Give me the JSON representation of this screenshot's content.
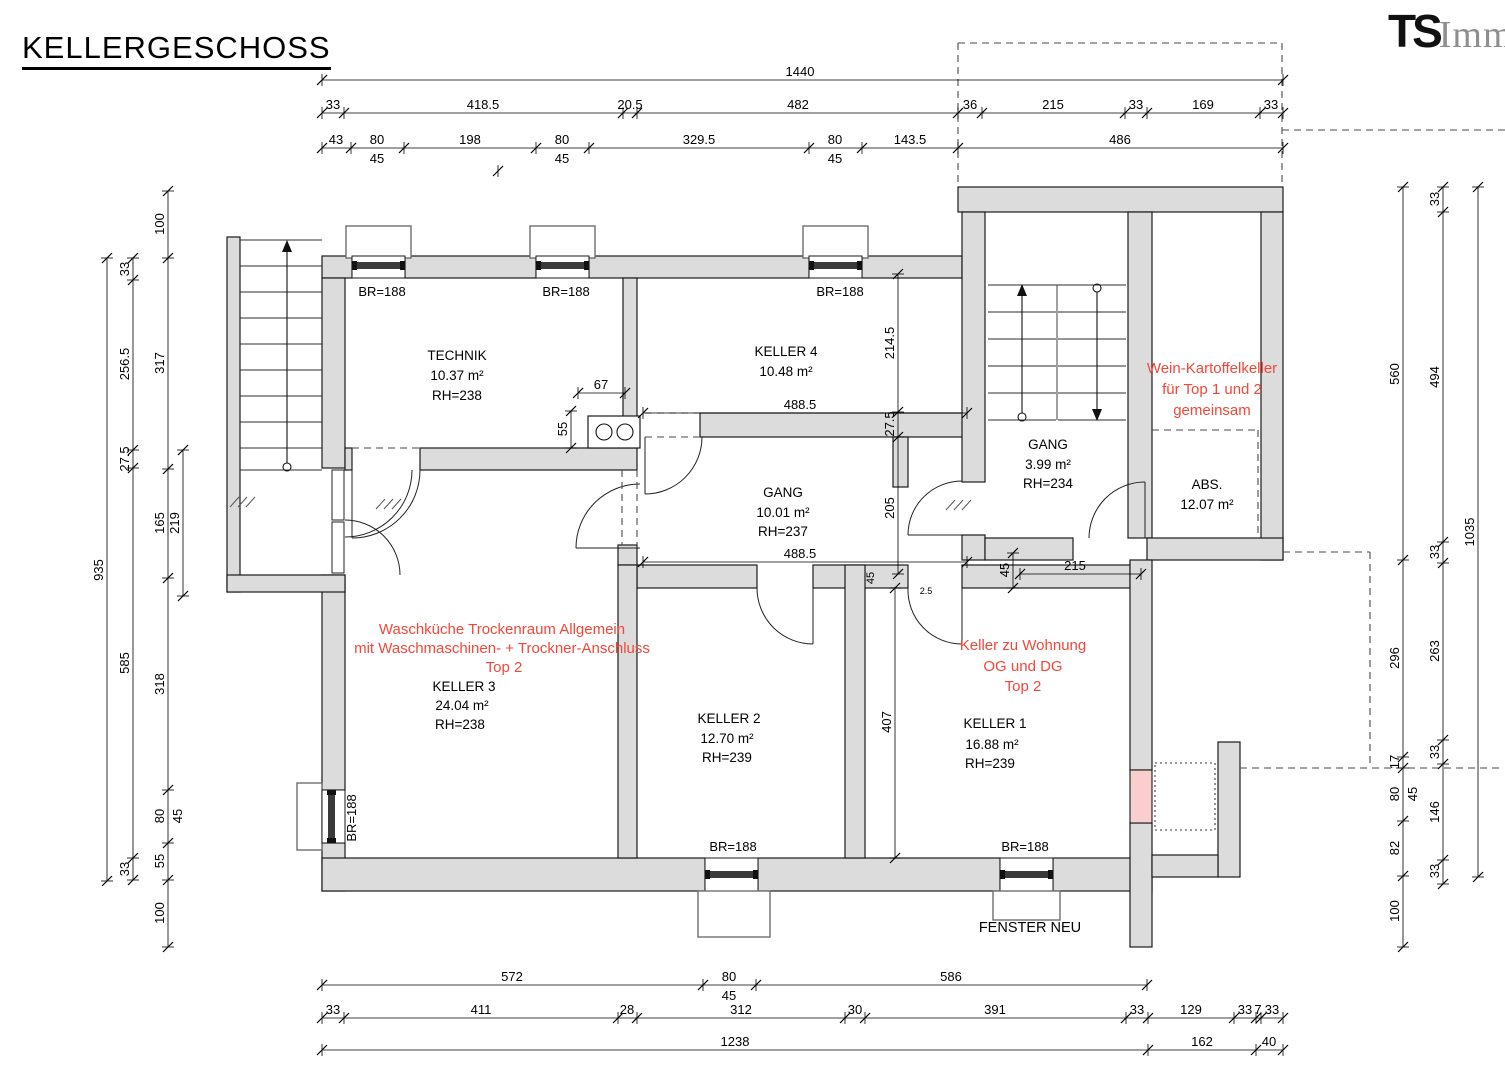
{
  "title": "KELLERGESCHOSS",
  "logo": {
    "bold": "TS",
    "rest": "Immo"
  },
  "colors": {
    "wall_fill": "#dcdcdc",
    "annotation_red": "#f4473a",
    "new_window_pink": "#f9cfcd",
    "background": "#ffffff"
  },
  "rooms": {
    "technik": {
      "name": "TECHNIK",
      "area": "10.37 m²",
      "rh": "RH=238"
    },
    "keller4": {
      "name": "KELLER 4",
      "area": "10.48 m²"
    },
    "gang": {
      "name": "GANG",
      "area": "10.01 m²",
      "rh": "RH=237"
    },
    "gang_stiegenhaus": {
      "name": "GANG",
      "area": "3.99 m²",
      "rh": "RH=234"
    },
    "abs": {
      "name": "ABS.",
      "area": "12.07 m²"
    },
    "keller3": {
      "name": "KELLER 3",
      "area": "24.04 m²",
      "rh": "RH=238"
    },
    "keller2": {
      "name": "KELLER 2",
      "area": "12.70 m²",
      "rh": "RH=239"
    },
    "keller1": {
      "name": "KELLER 1",
      "area": "16.88 m²",
      "rh": "RH=239"
    }
  },
  "annotations": {
    "keller3_red": [
      "Waschküche Trockenraum Allgemein",
      "mit Waschmaschinen- + Trockner-Anschluss",
      "Top 2"
    ],
    "keller1_red": [
      "Keller zu Wohnung",
      "OG und DG",
      "Top 2"
    ],
    "wein_red": [
      "Wein-Kartoffelkeller",
      "für Top 1 und 2",
      "gemeinsam"
    ],
    "fenster_neu": "FENSTER NEU",
    "br188": "BR=188"
  },
  "dim_chains": [
    {
      "o": "h",
      "c": 80,
      "s": 322,
      "e": 1283,
      "k": [
        322,
        1283
      ],
      "l": [
        {
          "t": "1440",
          "p": 800
        }
      ]
    },
    {
      "o": "h",
      "c": 113,
      "s": 322,
      "e": 1283,
      "k": [
        322,
        344,
        623,
        637,
        958,
        982,
        1125,
        1147,
        1260,
        1283
      ],
      "l": [
        {
          "t": "33",
          "p": 333
        },
        {
          "t": "418.5",
          "p": 483
        },
        {
          "t": "20.5",
          "p": 630
        },
        {
          "t": "482",
          "p": 798
        },
        {
          "t": "36",
          "p": 970
        },
        {
          "t": "215",
          "p": 1053
        },
        {
          "t": "33",
          "p": 1136
        },
        {
          "t": "169",
          "p": 1203
        },
        {
          "t": "33",
          "p": 1271
        }
      ]
    },
    {
      "o": "h",
      "c": 148,
      "s": 322,
      "e": 1283,
      "k": [
        322,
        351,
        404,
        536,
        589,
        809,
        862,
        958,
        1283
      ],
      "l": [
        {
          "t": "43",
          "p": 336
        },
        {
          "t": "80",
          "p": 377
        },
        {
          "t": "45",
          "p": 377,
          "f": 1
        },
        {
          "t": "198",
          "p": 470
        },
        {
          "t": "80",
          "p": 562
        },
        {
          "t": "45",
          "p": 562,
          "f": 1
        },
        {
          "t": "329.5",
          "p": 699
        },
        {
          "t": "80",
          "p": 835
        },
        {
          "t": "45",
          "p": 835,
          "f": 1
        },
        {
          "t": "143.5",
          "p": 910
        },
        {
          "t": "486",
          "p": 1120
        }
      ]
    },
    {
      "o": "h",
      "c": 985,
      "s": 322,
      "e": 1147,
      "k": [
        322,
        703,
        756,
        1147
      ],
      "l": [
        {
          "t": "572",
          "p": 512
        },
        {
          "t": "80",
          "p": 729
        },
        {
          "t": "45",
          "p": 729,
          "f": 1
        },
        {
          "t": "586",
          "p": 951
        }
      ]
    },
    {
      "o": "h",
      "c": 1018,
      "s": 322,
      "e": 1283,
      "k": [
        322,
        344,
        618,
        637,
        845,
        865,
        1126,
        1148,
        1234,
        1256,
        1261,
        1283
      ],
      "l": [
        {
          "t": "33",
          "p": 333
        },
        {
          "t": "411",
          "p": 481
        },
        {
          "t": "28",
          "p": 627
        },
        {
          "t": "312",
          "p": 741
        },
        {
          "t": "30",
          "p": 855
        },
        {
          "t": "391",
          "p": 995
        },
        {
          "t": "33",
          "p": 1137
        },
        {
          "t": "129",
          "p": 1191
        },
        {
          "t": "33",
          "p": 1245
        },
        {
          "t": "7",
          "p": 1258
        },
        {
          "t": "33",
          "p": 1272
        }
      ]
    },
    {
      "o": "h",
      "c": 1050,
      "s": 322,
      "e": 1283,
      "k": [
        322,
        1148,
        1256,
        1283
      ],
      "l": [
        {
          "t": "1238",
          "p": 735
        },
        {
          "t": "162",
          "p": 1202
        },
        {
          "t": "40",
          "p": 1269
        }
      ]
    },
    {
      "o": "v",
      "c": 107,
      "s": 258,
      "e": 881,
      "k": [
        258,
        881
      ],
      "l": [
        {
          "t": "935",
          "p": 570
        }
      ]
    },
    {
      "o": "v",
      "c": 133,
      "s": 258,
      "e": 880,
      "k": [
        258,
        280,
        450,
        468,
        858,
        880
      ],
      "l": [
        {
          "t": "33",
          "p": 269
        },
        {
          "t": "256.5",
          "p": 364
        },
        {
          "t": "27.5",
          "p": 459
        },
        {
          "t": "585",
          "p": 663
        },
        {
          "t": "33",
          "p": 869
        }
      ]
    },
    {
      "o": "v",
      "c": 168,
      "s": 191,
      "e": 947,
      "k": [
        191,
        258,
        469,
        578,
        790,
        843,
        880,
        947
      ],
      "l": [
        {
          "t": "100",
          "p": 224
        },
        {
          "t": "317",
          "p": 363
        },
        {
          "t": "165",
          "p": 523
        },
        {
          "t": "318",
          "p": 684
        },
        {
          "t": "80",
          "p": 816
        },
        {
          "t": "45",
          "p": 816,
          "f": 1
        },
        {
          "t": "55",
          "p": 861
        },
        {
          "t": "100",
          "p": 913
        }
      ]
    },
    {
      "o": "v",
      "c": 183,
      "s": 450,
      "e": 596,
      "k": [
        450,
        596
      ],
      "l": [
        {
          "t": "219",
          "p": 523
        }
      ]
    },
    {
      "o": "v",
      "c": 1403,
      "s": 187,
      "e": 947,
      "k": [
        187,
        560,
        757,
        768,
        821,
        876,
        947
      ],
      "l": [
        {
          "t": "560",
          "p": 374
        },
        {
          "t": "296",
          "p": 658
        },
        {
          "t": "17",
          "p": 762
        },
        {
          "t": "80",
          "p": 794
        },
        {
          "t": "45",
          "p": 794,
          "f": 1
        },
        {
          "t": "82",
          "p": 848
        },
        {
          "t": "100",
          "p": 911
        }
      ]
    },
    {
      "o": "v",
      "c": 1443,
      "s": 187,
      "e": 884,
      "k": [
        187,
        212,
        542,
        563,
        740,
        764,
        860,
        884
      ],
      "l": [
        {
          "t": "33",
          "p": 199
        },
        {
          "t": "494",
          "p": 377
        },
        {
          "t": "33",
          "p": 552
        },
        {
          "t": "263",
          "p": 651
        },
        {
          "t": "33",
          "p": 752
        },
        {
          "t": "146",
          "p": 812
        },
        {
          "t": "33",
          "p": 871
        }
      ]
    },
    {
      "o": "v",
      "c": 1478,
      "s": 187,
      "e": 877,
      "k": [
        187,
        877
      ],
      "l": [
        {
          "t": "1035",
          "p": 532
        }
      ]
    },
    {
      "o": "h",
      "c": 393,
      "s": 578,
      "e": 625,
      "k": [
        578,
        625
      ],
      "l": [
        {
          "t": "67",
          "p": 601
        }
      ]
    },
    {
      "o": "v",
      "c": 571,
      "s": 411,
      "e": 448,
      "k": [
        411,
        448
      ],
      "l": [
        {
          "t": "55",
          "p": 429
        }
      ]
    },
    {
      "o": "h",
      "c": 413,
      "s": 643,
      "e": 967,
      "k": [
        643,
        967
      ],
      "l": [
        {
          "t": "488.5",
          "p": 800
        }
      ]
    },
    {
      "o": "v",
      "c": 898,
      "s": 274,
      "e": 574,
      "k": [
        274,
        412,
        437,
        574
      ],
      "l": [
        {
          "t": "214.5",
          "p": 343
        },
        {
          "t": "27.5",
          "p": 424
        },
        {
          "t": "205",
          "p": 508
        }
      ]
    },
    {
      "o": "h",
      "c": 562,
      "s": 643,
      "e": 967,
      "k": [
        643,
        967
      ],
      "l": [
        {
          "t": "488.5",
          "p": 800
        }
      ]
    },
    {
      "o": "v",
      "c": 1013,
      "s": 553,
      "e": 588,
      "k": [
        553,
        588
      ],
      "l": [
        {
          "t": "45",
          "p": 570
        }
      ]
    },
    {
      "o": "h",
      "c": 574,
      "s": 1020,
      "e": 1141,
      "k": [
        1020,
        1141
      ],
      "l": [
        {
          "t": "215",
          "p": 1075
        }
      ]
    },
    {
      "o": "v",
      "c": 895,
      "s": 588,
      "e": 858,
      "k": [
        588,
        858
      ],
      "l": [
        {
          "t": "407",
          "p": 722
        }
      ]
    },
    {
      "o": "h",
      "c": 171,
      "s": 498,
      "e": 498,
      "k": [
        498
      ],
      "l": []
    }
  ],
  "extra_labels": [
    {
      "t": "2.5",
      "x": 926,
      "y": 594,
      "s": 9
    },
    {
      "t": "45",
      "x": 874,
      "y": 578,
      "r": 1,
      "s": 11
    }
  ]
}
